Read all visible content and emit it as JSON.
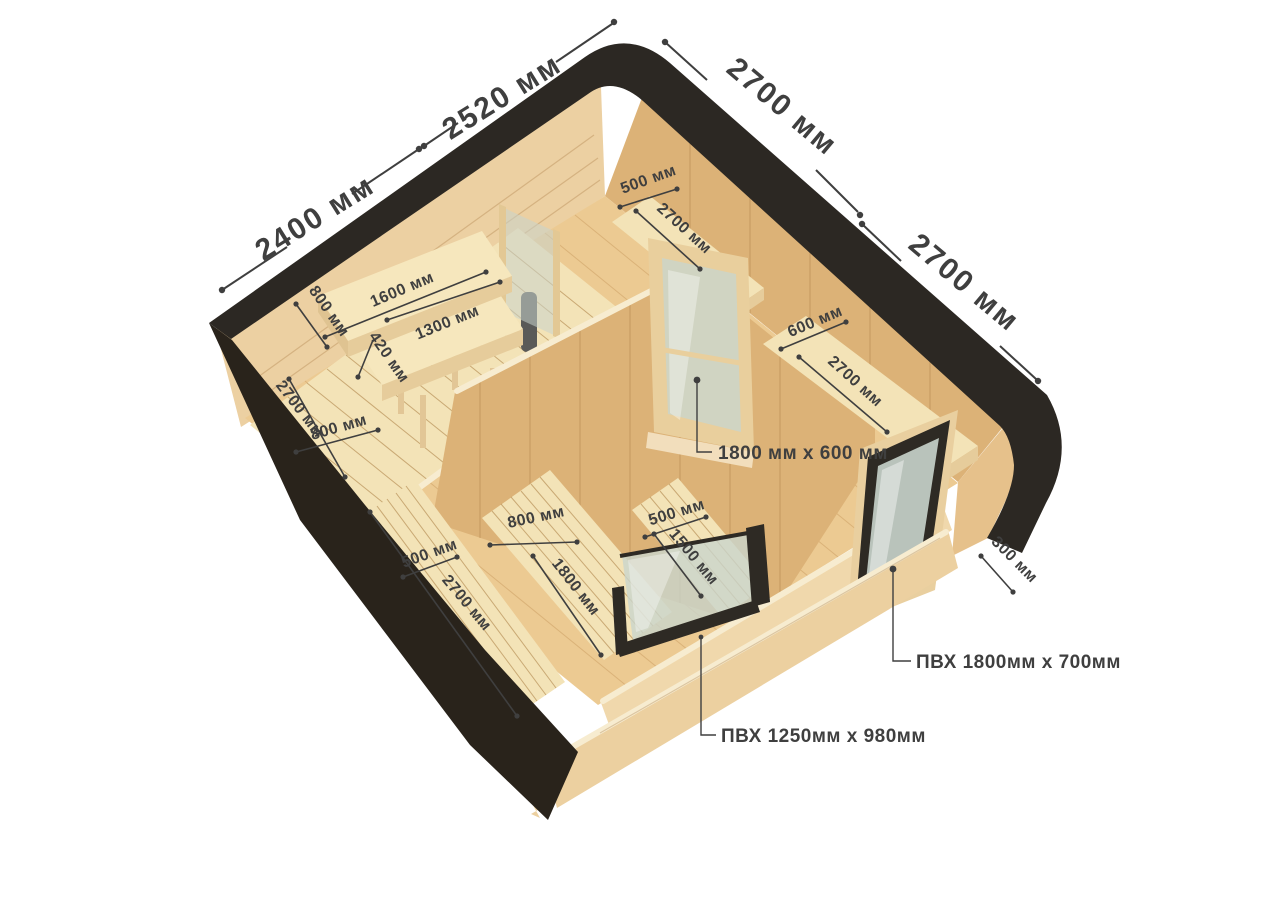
{
  "unit": "мм",
  "colors": {
    "background": "#ffffff",
    "roof": "#2c2823",
    "outer_wall_dark": "#29231b",
    "wall_pine": "#ecd0a2",
    "wall_tan": "#dcb277",
    "wall_tan_dark": "#d4a86c",
    "floor": "#ecca92",
    "deck": "#f3e3b7",
    "bench": "#f6e7bd",
    "bench_edge": "#e6cc9b",
    "frame_dark": "#2e2a24",
    "glass": "#c9d4cc",
    "stove": "#5a5a58",
    "dim": "#3f3f3f"
  },
  "dims": {
    "gable_2400": "2400 мм",
    "gable_2520": "2520 мм",
    "roof_2700_a": "2700 мм",
    "roof_2700_b": "2700 мм",
    "bench_width_800": "800 мм",
    "bench_top_1600": "1600 мм",
    "bench_low_1300": "1300 мм",
    "bench_step_420": "420 мм",
    "platform_len_2700": "2700 мм",
    "platform_width_800": "800 мм",
    "shelf_top_width_500": "500 мм",
    "shelf_top_len_2700": "2700 мм",
    "shelf_right_width_600": "600 мм",
    "shelf_right_len_2700": "2700 мм",
    "deck_left_width_500": "500 мм",
    "deck_left_len_2700": "2700 мм",
    "deck_mid_width_800": "800 мм",
    "deck_mid_len_1800": "1800 мм",
    "deck_right_width_500": "500 мм",
    "deck_right_len_1500": "1500 мм",
    "wall_edge_300": "300 мм",
    "glass_door": "1800 мм x 600 мм",
    "window_pvc_right": "ПВХ 1800мм x 700мм",
    "window_pvc_front": "ПВХ 1250мм x 980мм"
  }
}
